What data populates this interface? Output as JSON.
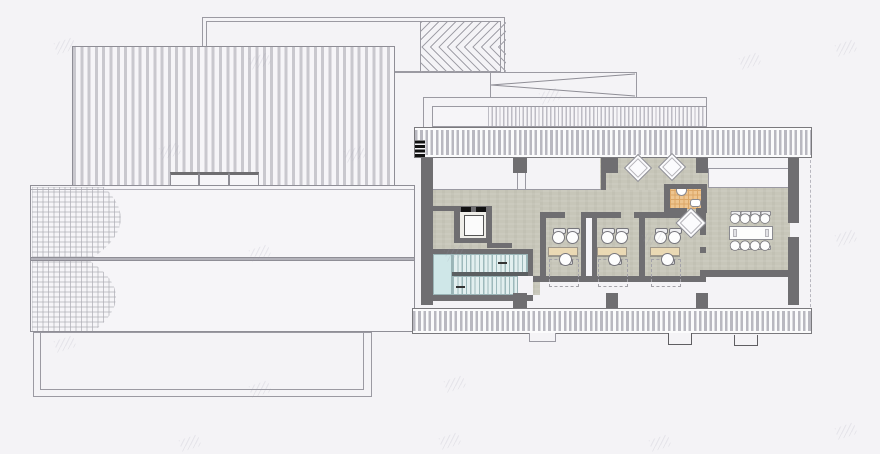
{
  "drawing": {
    "kind": "architectural-plan",
    "left_sheet": "roof-plan",
    "right_sheet": "office-floor-plan",
    "visible_text": ""
  },
  "colors": {
    "background": "#f4f3f6",
    "wall": "#6f6e71",
    "floor": "#c7c6b9",
    "stair_landing": "#cfe7e8",
    "stair_treads": "#e2efef",
    "bath_tile": "#eec58f",
    "bath_grid": "#dca767",
    "desk": "#ead9b4",
    "roof_stripe": "#c9c8ce",
    "line": "#9a99a2"
  },
  "floor_plan": {
    "offices": {
      "count": 3,
      "desk_origins_x": [
        548,
        597,
        650
      ],
      "desk_y": 247,
      "desk_w": 30,
      "desk_h": 9,
      "chairs_top_dx": [
        6,
        20
      ],
      "chair_bottom_dx": 13,
      "dashed_zone": {
        "dy": 12,
        "w": 30,
        "h": 28
      }
    },
    "conference": {
      "table": {
        "x": 729,
        "y": 226,
        "w": 44,
        "h": 14
      },
      "chair_cx": [
        731,
        741,
        751,
        761
      ],
      "chair_cy_top": 213,
      "chair_cy_bottom": 240
    },
    "diamond_tables": [
      {
        "x": 638,
        "y": 168,
        "r": 10
      },
      {
        "x": 672,
        "y": 167,
        "r": 10
      },
      {
        "x": 691,
        "y": 223,
        "r": 11
      }
    ],
    "piers": {
      "top": [
        [
          513,
          158,
          14,
          15
        ],
        [
          605,
          158,
          13,
          15
        ],
        [
          696,
          158,
          12,
          15
        ]
      ],
      "bottom": [
        [
          513,
          293,
          14,
          15
        ],
        [
          606,
          293,
          12,
          15
        ],
        [
          696,
          293,
          12,
          15
        ]
      ]
    },
    "tabs": [
      {
        "x": 529,
        "y": 333,
        "w": 27,
        "h": 9,
        "tone": "#9a99a2"
      },
      {
        "x": 668,
        "y": 333,
        "w": 24,
        "h": 12,
        "tone": "#5f5e62"
      },
      {
        "x": 734,
        "y": 335,
        "w": 24,
        "h": 11,
        "tone": "#5f5e62"
      }
    ],
    "watermarks": [
      [
        55,
        40
      ],
      [
        250,
        55
      ],
      [
        160,
        145
      ],
      [
        345,
        148
      ],
      [
        540,
        90
      ],
      [
        740,
        55
      ],
      [
        836,
        42
      ],
      [
        250,
        247
      ],
      [
        445,
        247
      ],
      [
        643,
        232
      ],
      [
        836,
        232
      ],
      [
        55,
        338
      ],
      [
        250,
        383
      ],
      [
        445,
        378
      ],
      [
        180,
        437
      ],
      [
        440,
        435
      ],
      [
        650,
        437
      ],
      [
        836,
        425
      ]
    ]
  }
}
